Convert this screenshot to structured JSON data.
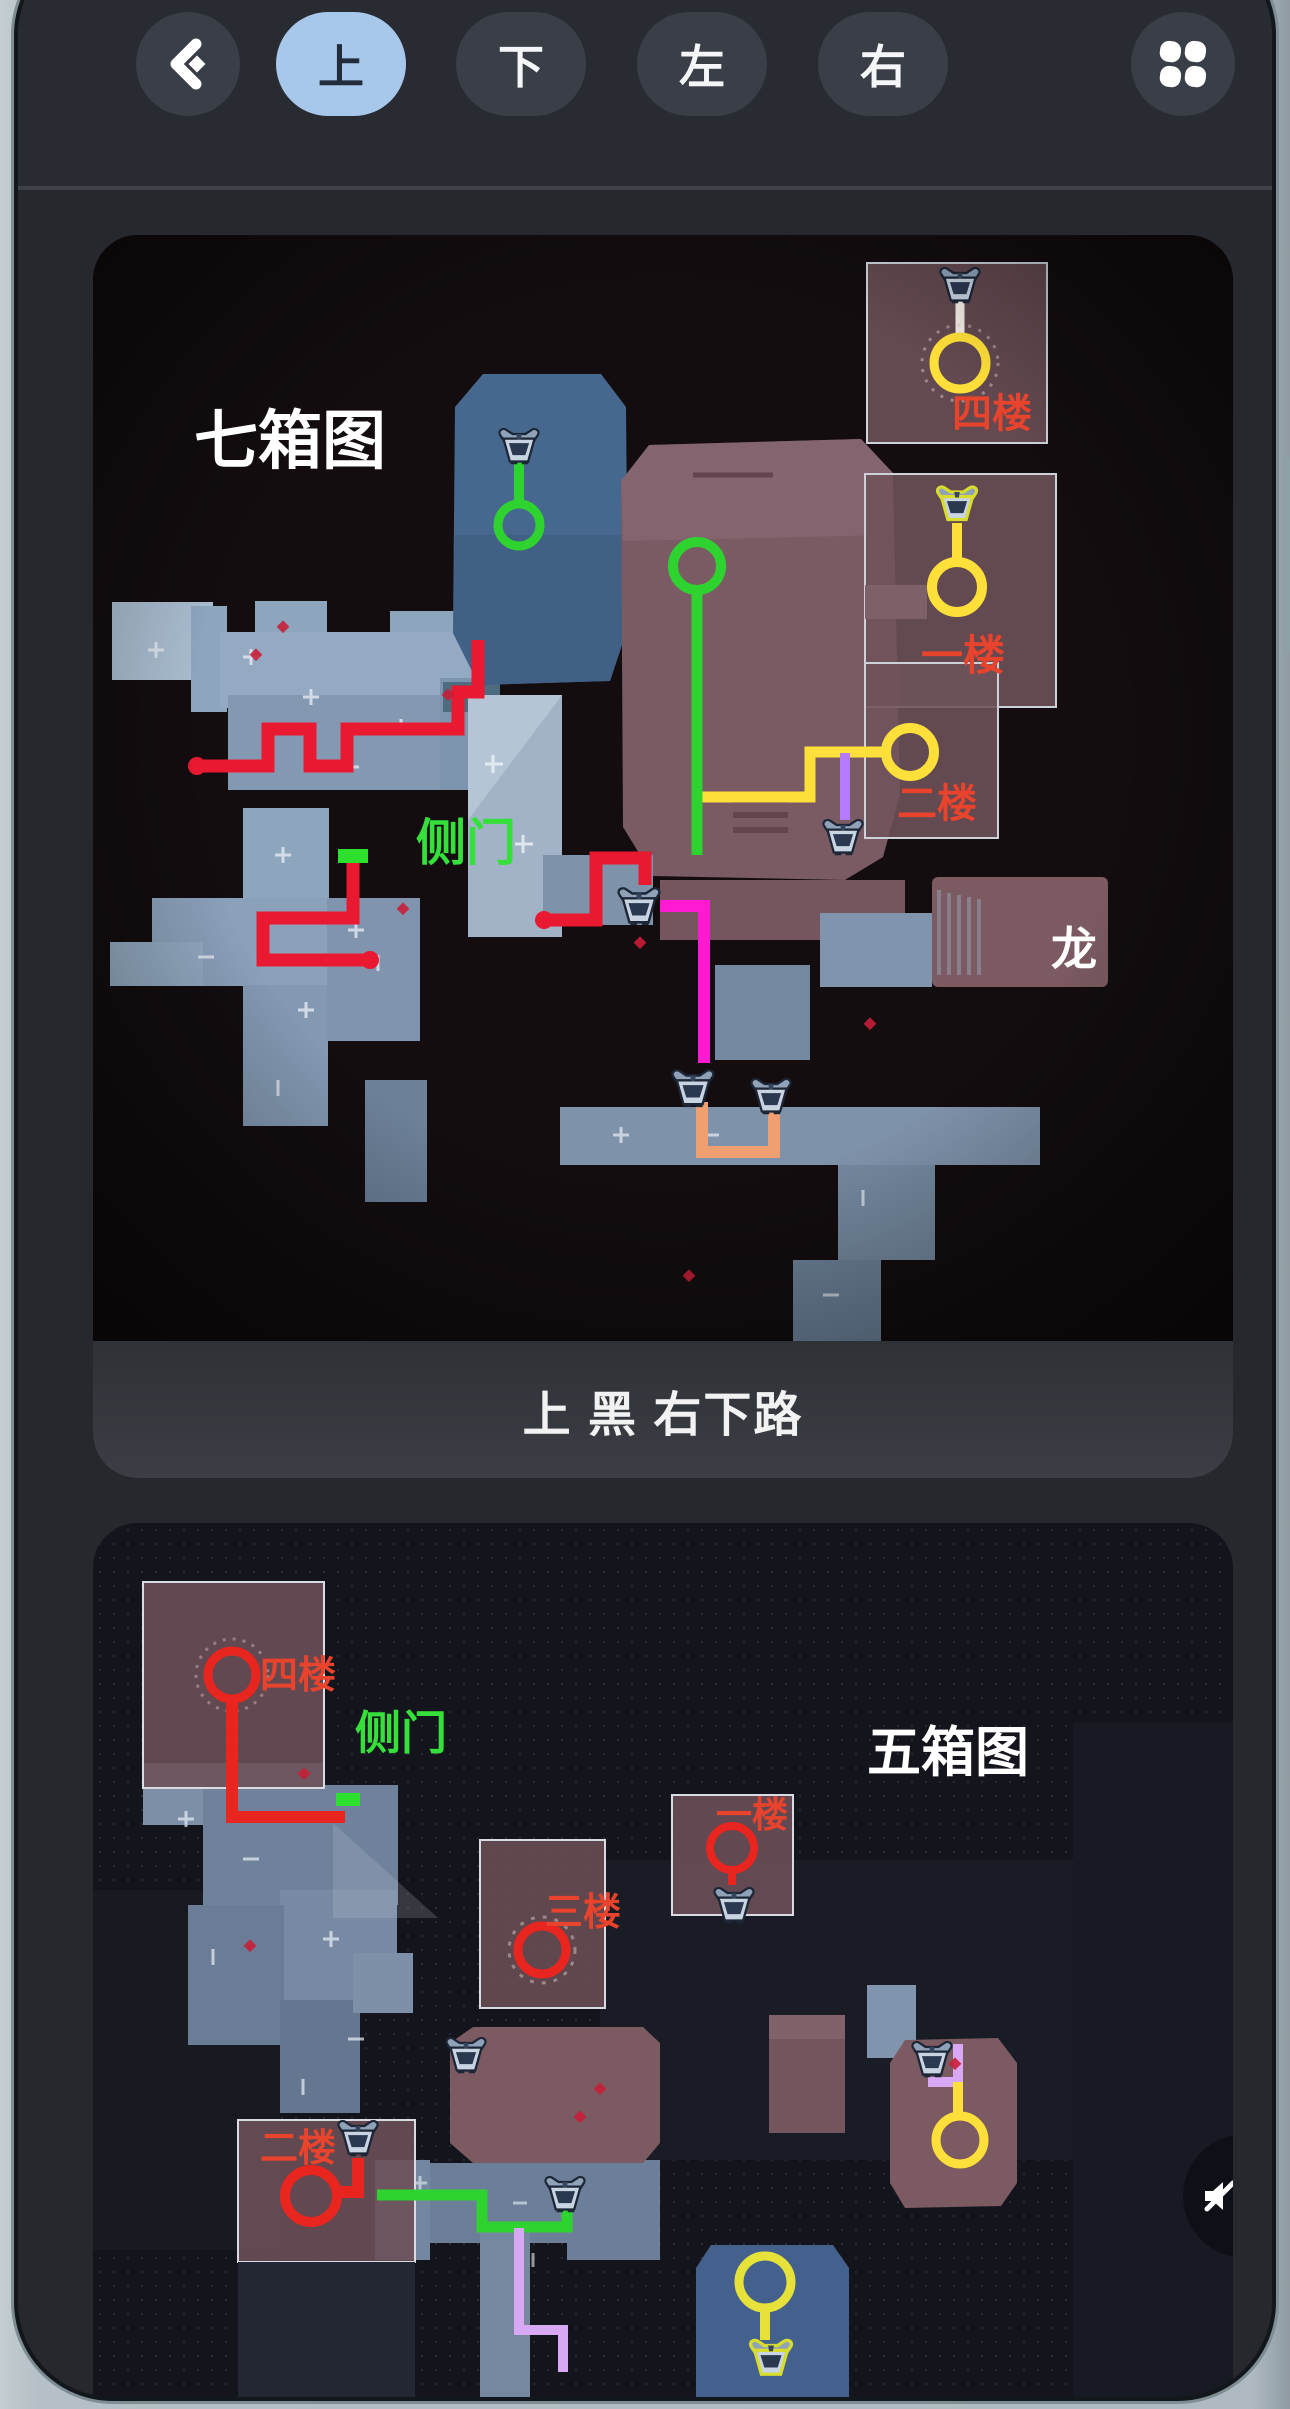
{
  "nav": {
    "back_icon": "chevron-left",
    "tabs": [
      {
        "label": "上",
        "active": true
      },
      {
        "label": "下",
        "active": false
      },
      {
        "label": "左",
        "active": false
      },
      {
        "label": "右",
        "active": false
      }
    ],
    "menu_icon": "grid-clover"
  },
  "map1": {
    "title": "七箱图",
    "caption": "上 黑 右下路",
    "labels": {
      "floor4": "四楼",
      "floor1": "一楼",
      "floor2": "二楼",
      "side_door": "侧门",
      "dragon": "龙"
    }
  },
  "map2": {
    "title": "五箱图",
    "labels": {
      "floor4": "四楼",
      "side_door": "侧门",
      "floor1": "一楼",
      "floor3": "三楼",
      "floor2": "二楼"
    }
  },
  "colors": {
    "active_tab": "#a7c8ea",
    "route_red": "#e81930",
    "route_green": "#2fd32f",
    "route_yellow": "#ffe03a",
    "route_magenta": "#ff1ad1",
    "route_orange": "#f0a070",
    "route_violet": "#d9a8f5",
    "floor_label": "#e8432c",
    "door_label": "#35e03a"
  }
}
